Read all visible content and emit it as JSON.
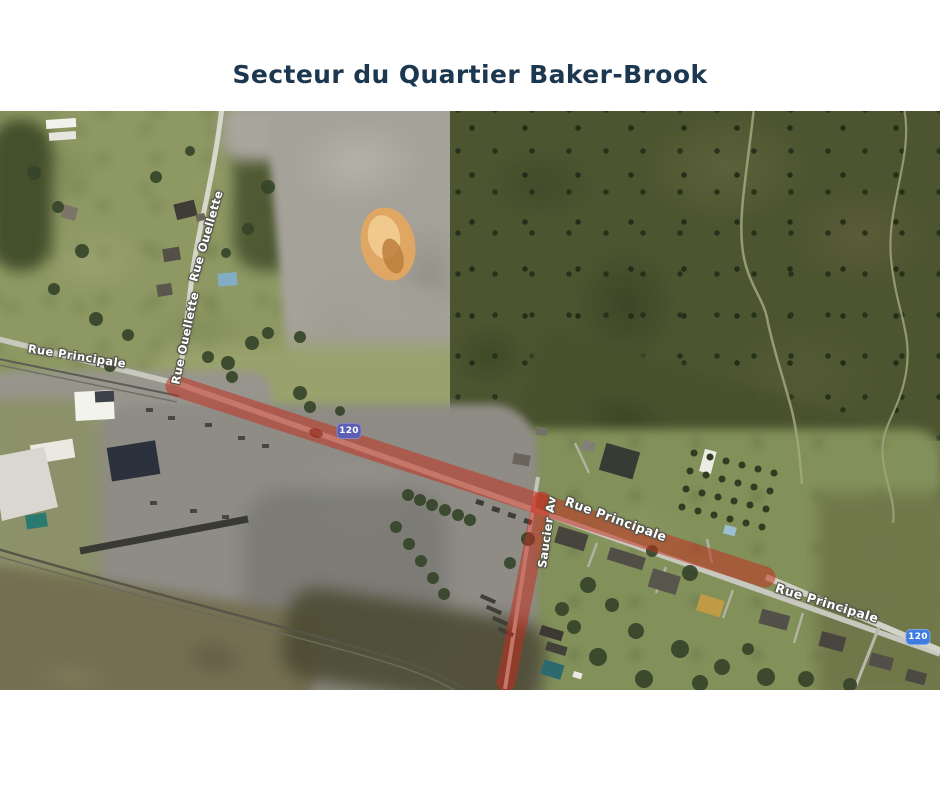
{
  "title": "Secteur du Quartier Baker-Brook",
  "map": {
    "highlight_color": "#c72c1c",
    "road_labels": [
      {
        "id": "rue-principale-west",
        "text": "Rue Principale"
      },
      {
        "id": "rue-ouellette-upper",
        "text": "Rue Ouellette"
      },
      {
        "id": "rue-ouellette-lower",
        "text": "Rue Ouellette"
      },
      {
        "id": "rue-principale-center",
        "text": "Rue Principale"
      },
      {
        "id": "saucier-av",
        "text": "Saucier Av"
      },
      {
        "id": "rue-principale-east",
        "text": "Rue Principale"
      }
    ],
    "route_shields": [
      {
        "id": "route-120-west",
        "text": "120",
        "color": "#5b5eb2"
      },
      {
        "id": "route-120-east",
        "text": "120",
        "color": "#3e7ce0"
      }
    ]
  }
}
